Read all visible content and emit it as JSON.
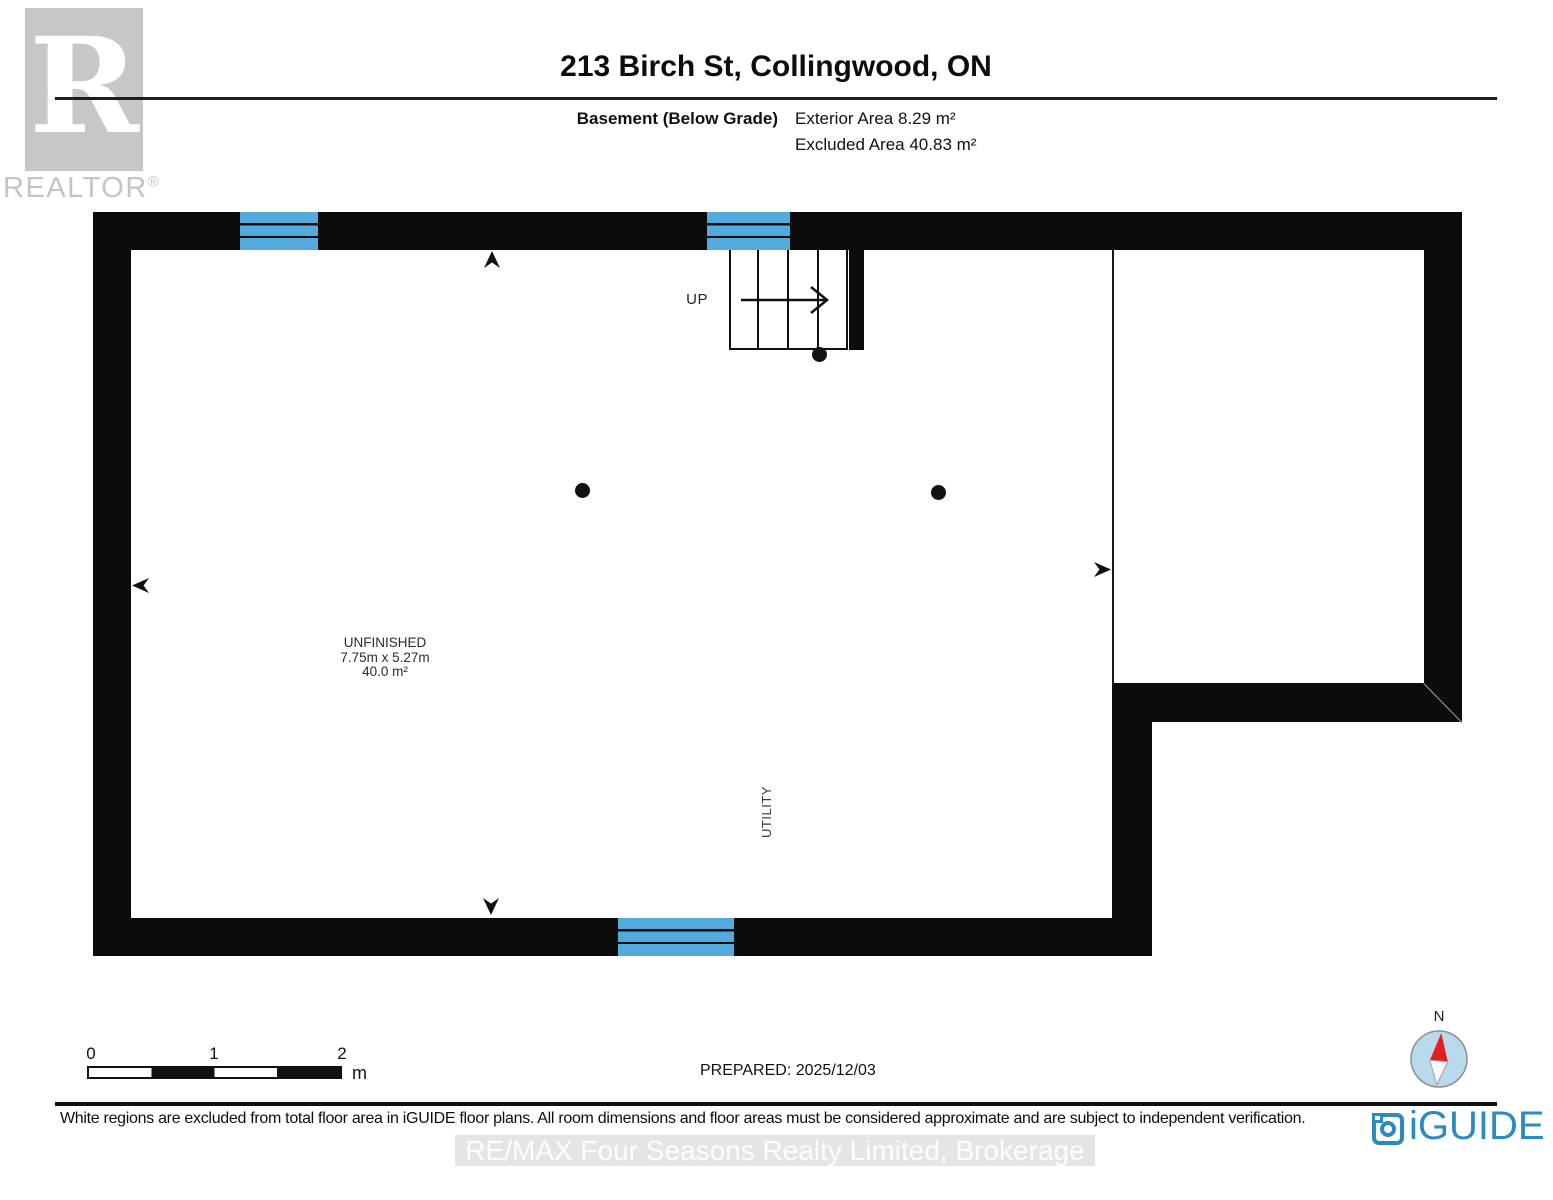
{
  "header": {
    "logo_letter": "R",
    "logo_wordmark": "REALTOR",
    "logo_registered": "®",
    "title": "213 Birch St, Collingwood, ON",
    "floor_label": "Basement (Below Grade)",
    "exterior_area": "Exterior Area 8.29 m²",
    "excluded_area": "Excluded Area 40.83 m²"
  },
  "plan": {
    "room": {
      "name": "UNFINISHED",
      "dimensions": "7.75m x 5.27m",
      "area": "40.0 m²"
    },
    "utility_label": "UTILITY",
    "stairs_label": "UP",
    "colors": {
      "wall": "#0b0b0b",
      "window": "#55aadd"
    }
  },
  "scale_bar": {
    "ticks": [
      "0",
      "1",
      "2"
    ],
    "unit": "m"
  },
  "prepared": "PREPARED: 2025/12/03",
  "compass": {
    "north_label": "N"
  },
  "footer": {
    "disclaimer": "White regions are excluded from total floor area in iGUIDE floor plans. All room dimensions and floor areas must be considered approximate and are subject to independent verification.",
    "brand": "iGUIDE",
    "watermark": "RE/MAX Four Seasons Realty Limited, Brokerage"
  }
}
